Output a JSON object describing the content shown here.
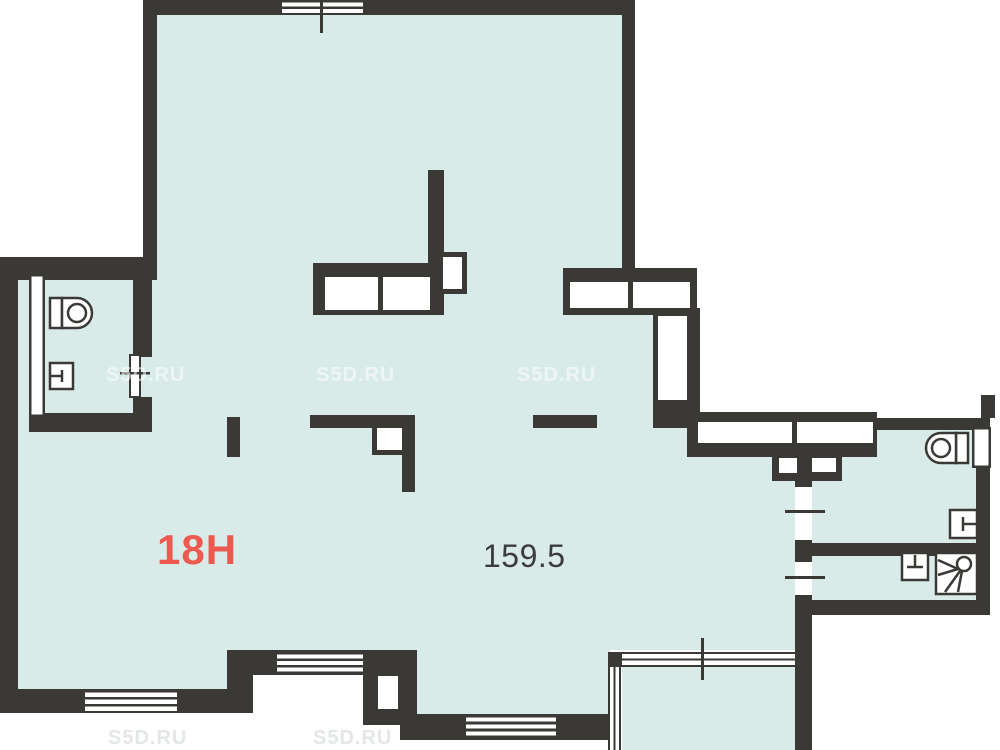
{
  "plan": {
    "unit_label": "18H",
    "area_value": "159.5",
    "watermark_text": "S5D.RU"
  },
  "colors": {
    "wall": "#3a3936",
    "interior": "#d9ebe9",
    "background": "#ffffff",
    "unit_label": "#ec5a4f",
    "area_label": "#3c3c3c",
    "watermark": "#ffffff",
    "watermark_faint": "#e2e6e5"
  },
  "fixtures": [
    {
      "icon": "toilet-icon",
      "room": "wc-top-left"
    },
    {
      "icon": "sink-icon",
      "room": "wc-top-left"
    },
    {
      "icon": "toilet-icon",
      "room": "bathroom-upper-right"
    },
    {
      "icon": "sink-icon",
      "room": "bathroom-upper-right"
    },
    {
      "icon": "sink-icon",
      "room": "bathroom-lower-right"
    },
    {
      "icon": "shower-icon",
      "room": "bathroom-lower-right"
    }
  ]
}
